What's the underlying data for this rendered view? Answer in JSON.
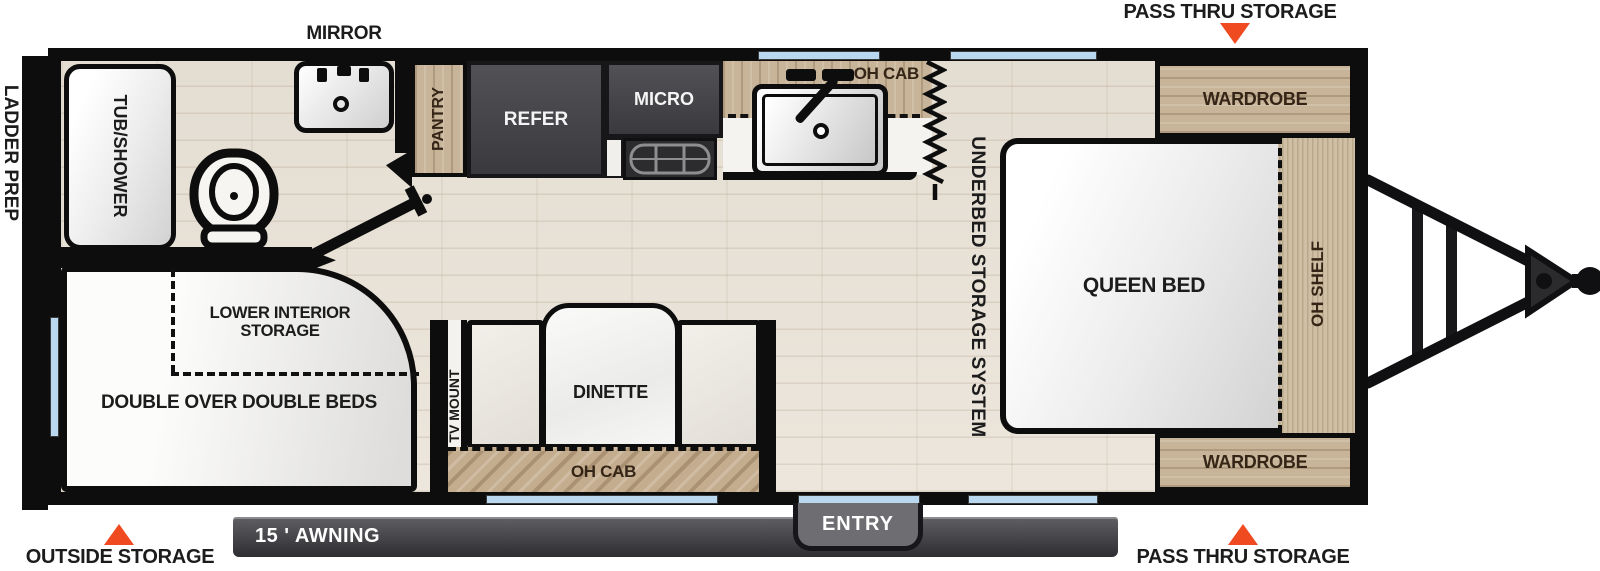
{
  "plan": {
    "exterior": {
      "pass_thru_storage_top": "PASS THRU STORAGE",
      "pass_thru_storage_bottom": "PASS THRU STORAGE",
      "outside_storage": "OUTSIDE STORAGE",
      "ladder_prep": "LADDER PREP",
      "awning": "15 ' AWNING",
      "entry": "ENTRY",
      "mirror": "MIRROR"
    },
    "bathroom": {
      "tub_shower": "TUB/SHOWER"
    },
    "kitchen": {
      "pantry": "PANTRY",
      "refrigerator": "REFER",
      "microwave": "MICRO",
      "overhead_cabinet": "OH CAB"
    },
    "bedroom": {
      "queen_bed": "QUEEN BED",
      "underbed_storage": "UNDERBED STORAGE SYSTEM",
      "wardrobe_front_top": "WARDROBE",
      "wardrobe_front_bottom": "WARDROBE",
      "overhead_shelf": "OH SHELF"
    },
    "bunkroom": {
      "double_beds": "DOUBLE OVER DOUBLE BEDS",
      "lower_interior_storage": "LOWER INTERIOR STORAGE"
    },
    "living": {
      "tv_mount": "TV MOUNT",
      "dinette": "DINETTE",
      "overhead_cabinet": "OH CAB"
    },
    "colors": {
      "callout_red": "#f04a20",
      "wood": "#c8b498",
      "appliance_dark": "#46464a",
      "window_blue": "#b9d7ee",
      "wall_black": "#0d0d0d",
      "floor": "#e9e3d9"
    }
  }
}
